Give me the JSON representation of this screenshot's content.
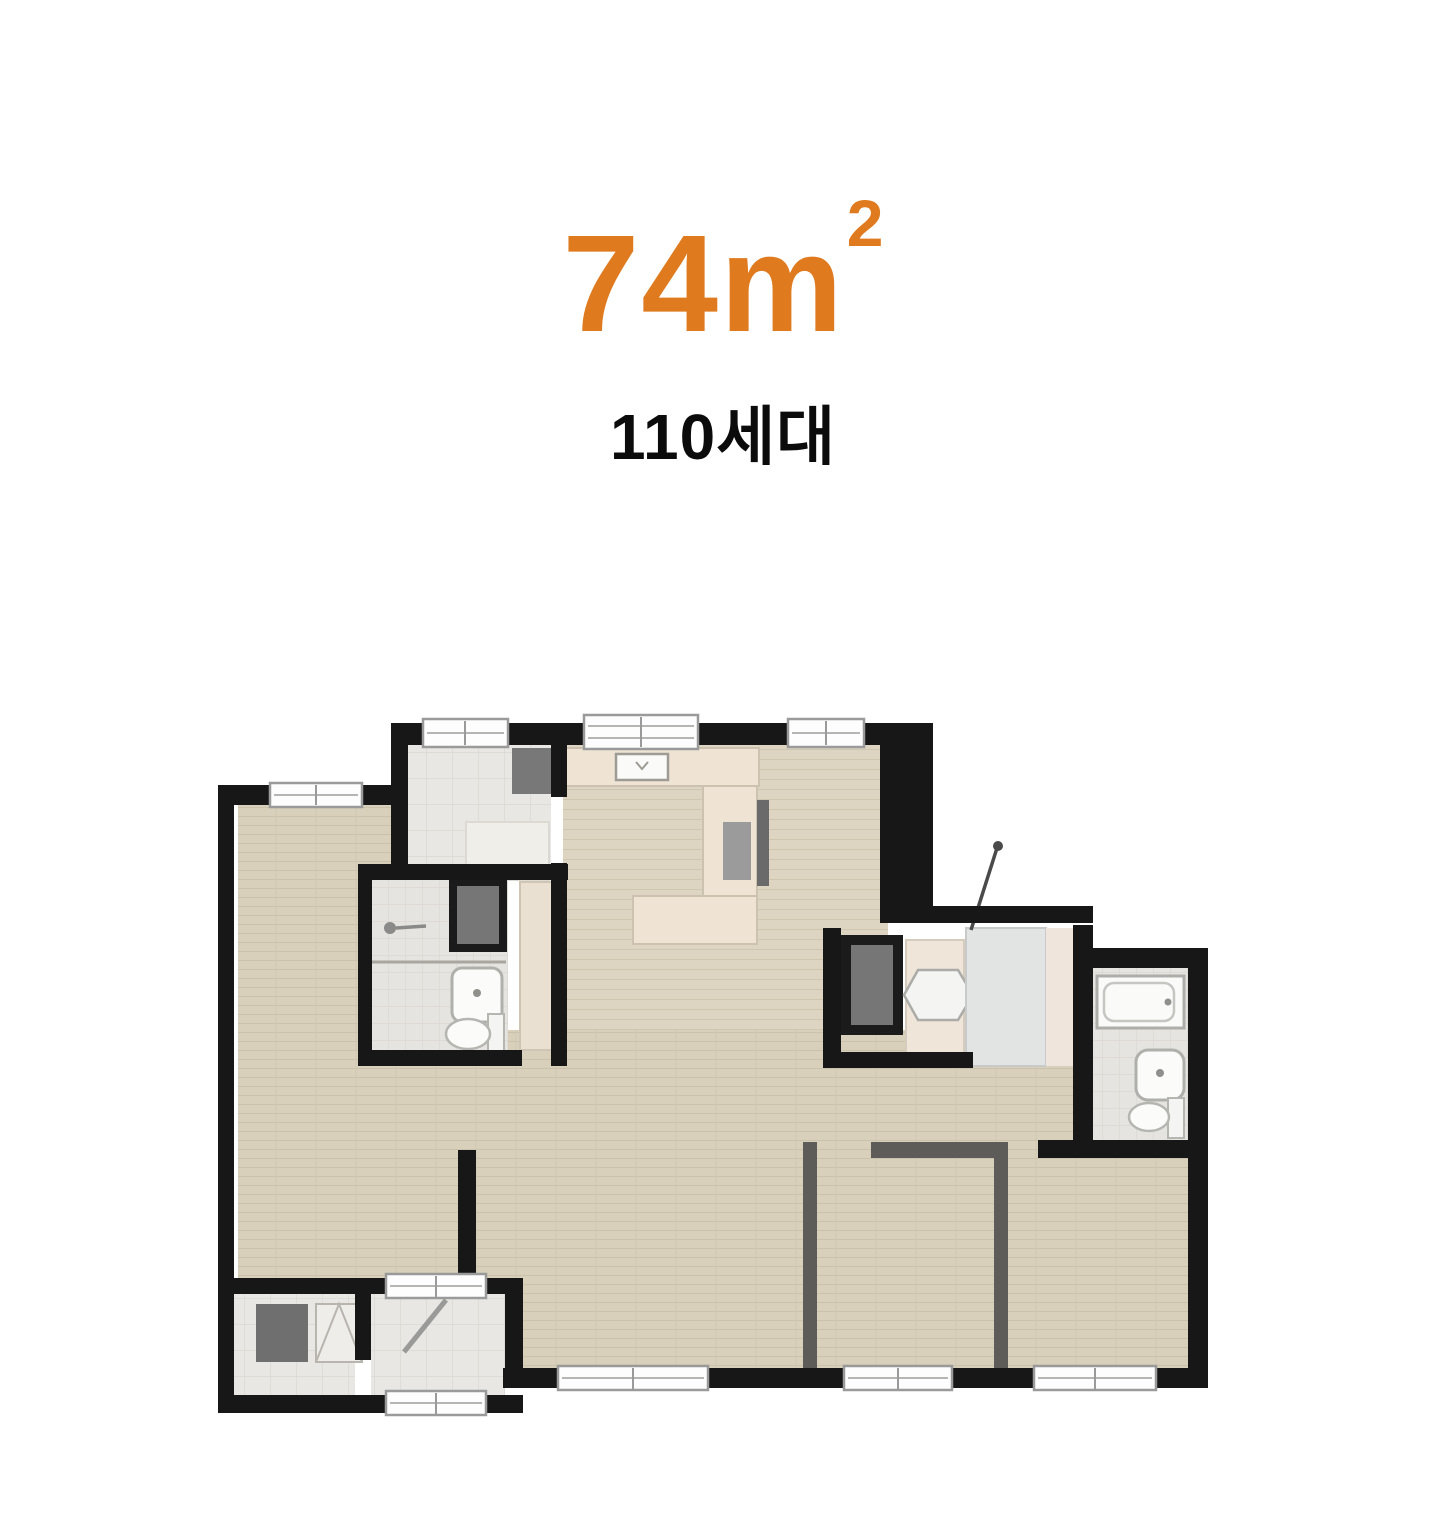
{
  "header": {
    "area": {
      "value": "74",
      "unit_base": "m",
      "unit_exponent": "2",
      "display": "74㎡"
    },
    "households": "110세대"
  },
  "colors": {
    "accent": "#DF7A1E",
    "title_text": "#0B0B0B",
    "wall": "#171717",
    "wood_floor": "#D8D0BB",
    "wood_line": "#CBC2AD",
    "tile_floor": "#E9E7E3",
    "tile_line": "#DBD8D2",
    "bath_tile": "#E6E4E0",
    "counter": "#EFE4D4",
    "wardrobe": "#EAE0D1",
    "dark_cabinet": "#737373",
    "partition": "#5E5C58",
    "window_frame": "#9A9A9A",
    "fixture_white": "#FBFBFA",
    "shower_tile": "#E2E4E3",
    "accent_strip": "#F0E5DD"
  },
  "floor_plan": {
    "type": "apartment-unit-floor-plan",
    "area_label": "74㎡",
    "rooms": [
      "bedroom-left",
      "utility-room-top-left",
      "dressing-room-left",
      "bathroom-left",
      "kitchen",
      "dining-room-top-right",
      "living-room",
      "dressing-room-right",
      "shower-room",
      "bathroom-right",
      "bedroom-bottom-center",
      "bedroom-bottom-right",
      "entrance",
      "storage-room-bottom-left"
    ],
    "fixtures": [
      "kitchen-counter",
      "kitchen-sink",
      "cooktop",
      "refrigerator",
      "wash-basin-left",
      "toilet-left",
      "shower-head",
      "wardrobe-cabinet",
      "closet-utility",
      "closet-dressing",
      "wash-basin-dressing",
      "shower-booth",
      "shower-rod",
      "bathtub",
      "wash-basin-right",
      "toilet-right",
      "shoe-cabinet",
      "storage-shelf",
      "entrance-door"
    ],
    "windows_count": 9
  }
}
